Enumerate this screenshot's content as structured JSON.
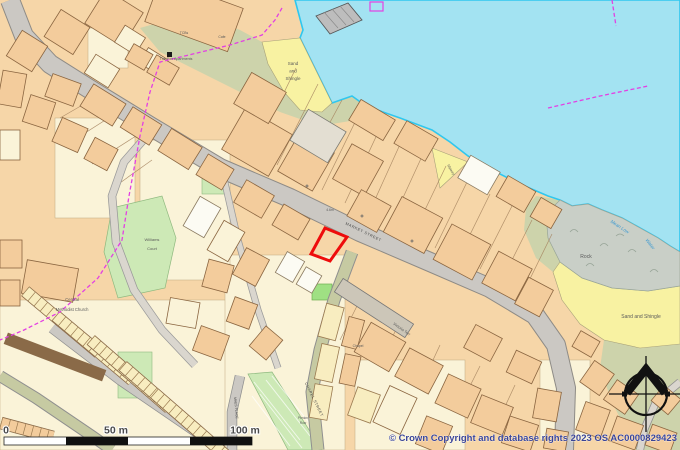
{
  "map": {
    "description": "Ordnance Survey style town-centre planning map with red site outline",
    "site_outline_color": "#ee0c0c"
  },
  "colors": {
    "sea": "#a3e3f2",
    "coast": "#2fc7ef",
    "land": "#f6d6a8",
    "cream": "#faf3d8",
    "beach": "#f8f2a2",
    "rock": "#c9cfc7",
    "light_green": "#cde9b6",
    "vivid_green": "#9fe083",
    "sage": "#cdd3ab",
    "road_fill": "#cbc8c3",
    "road_casing": "#8e8b86",
    "road_khaki": "#c6caa2",
    "lane_fill": "#dad6ce",
    "boundary": "#e340e3",
    "site_outline": "#ee0c0c",
    "label_gray": "#5a5a5a",
    "water_label_blue": "#3d9ad1",
    "copyright_blue": "#3a4496"
  },
  "map_labels": [
    {
      "text": "Sand",
      "x": 293,
      "y": 65,
      "size": 4.5
    },
    {
      "text": "and",
      "x": 293,
      "y": 72.5,
      "size": 4.5
    },
    {
      "text": "Shingle",
      "x": 293,
      "y": 80,
      "size": 4.5
    },
    {
      "text": "Sand and Shingle",
      "x": 641,
      "y": 318,
      "size": 5
    },
    {
      "text": "Rock",
      "x": 586,
      "y": 258,
      "size": 5
    },
    {
      "text": "Mean Low",
      "x": 619,
      "y": 228,
      "size": 4.6,
      "rot": 33,
      "color": "#3d9ad1",
      "italic": true
    },
    {
      "text": "Water",
      "x": 649,
      "y": 245,
      "size": 4.6,
      "rot": 52,
      "color": "#3d9ad1",
      "italic": true
    },
    {
      "text": "MARKET STREET",
      "x": 363,
      "y": 233,
      "size": 3.8,
      "rot": 26,
      "color": "#4a4a4a",
      "ls": 0.6
    },
    {
      "text": "Central",
      "x": 72,
      "y": 301,
      "size": 4.2
    },
    {
      "text": "Methodist Church",
      "x": 72,
      "y": 311,
      "size": 4.2
    },
    {
      "text": "Williams",
      "x": 152,
      "y": 241,
      "size": 4
    },
    {
      "text": "Court",
      "x": 152,
      "y": 250,
      "size": 4
    },
    {
      "text": "The Pier Apartments",
      "x": 176,
      "y": 60,
      "size": 3.6
    },
    {
      "text": "TCBs",
      "x": 184,
      "y": 34,
      "size": 3.4
    },
    {
      "text": "Cafe",
      "x": 222,
      "y": 38,
      "size": 3.4
    },
    {
      "text": "Victoria Terr",
      "x": 401,
      "y": 330,
      "size": 3.8,
      "rot": 35
    },
    {
      "text": "Chapel",
      "x": 358,
      "y": 347,
      "size": 3.4
    },
    {
      "text": "4.6m",
      "x": 330,
      "y": 211,
      "size": 3.4
    },
    {
      "text": "CHAPEL STREET",
      "x": 313,
      "y": 400,
      "size": 3.8,
      "rot": 64,
      "color": "#4a4a4a",
      "ls": 0.5
    },
    {
      "text": "Slipway",
      "x": 450,
      "y": 170,
      "size": 3.4,
      "rot": 60
    },
    {
      "text": "MAES PLACE",
      "x": 235,
      "y": 408,
      "size": 3.4,
      "rot": 85,
      "color": "#4a4a4a"
    },
    {
      "text": "Penlon",
      "x": 303,
      "y": 419,
      "size": 3.2
    },
    {
      "text": "Row",
      "x": 303,
      "y": 424,
      "size": 3.2
    }
  ],
  "scalebar": {
    "labels": [
      "0",
      "50 m",
      "100 m"
    ]
  },
  "copyright": "© Crown Copyright and database rights 2023 OS AC0000829423"
}
